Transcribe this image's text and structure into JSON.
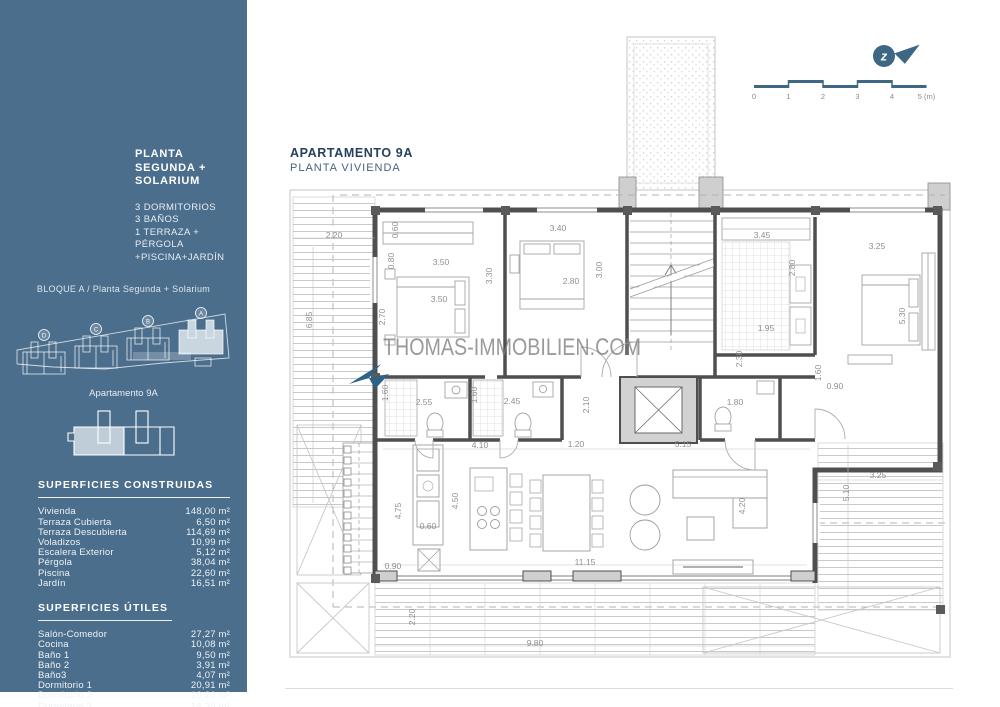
{
  "colors": {
    "sidebar_bg": "#4b6e8c",
    "accent_dark": "#24425e",
    "plan_wall": "#4f4f4f",
    "brand_blue": "#3e6784",
    "watermark_gray": "#7d7d7d",
    "highlight_block": "#c9d6e0"
  },
  "sidebar": {
    "title_line1": "PLANTA SEGUNDA +",
    "title_line2": "SOLARIUM",
    "features": [
      "3 DORMITORIOS",
      "3 BAÑOS",
      "1 TERRAZA + PÉRGOLA",
      "+PISCINA+JARDÍN"
    ],
    "block_caption": "BLOQUE A / Planta Segunda + Solarium",
    "block_labels": [
      "D",
      "C",
      "B",
      "A"
    ],
    "apartment_caption": "Apartamento 9A",
    "constructed": {
      "heading": "SUPERFICIES CONSTRUIDAS",
      "rows": [
        {
          "label": "Vivienda",
          "value": "148,00 m²"
        },
        {
          "label": "Terraza Cubierta",
          "value": "6,50 m²"
        },
        {
          "label": "Terraza Descubierta",
          "value": "114,69 m²"
        },
        {
          "label": "Voladizos",
          "value": "10,99 m²"
        },
        {
          "label": "Escalera Exterior",
          "value": "5,12 m²"
        },
        {
          "label": "Pérgola",
          "value": "38,04 m²"
        },
        {
          "label": "Piscina",
          "value": "22,60 m²"
        },
        {
          "label": "Jardín",
          "value": "16,51 m²"
        }
      ]
    },
    "useful": {
      "heading": "SUPERFICIES ÚTILES",
      "rows": [
        {
          "label": "Salón-Comedor",
          "value": "27,27 m²"
        },
        {
          "label": "Cocina",
          "value": "10,08 m²"
        },
        {
          "label": "Baño 1",
          "value": "9,50 m²"
        },
        {
          "label": "Baño 2",
          "value": "3,91 m²"
        },
        {
          "label": "Baño3",
          "value": "4,07 m²"
        },
        {
          "label": "Dormitorio 1",
          "value": "20,91 m²"
        },
        {
          "label": "Dormitorio 2",
          "value": "10,20 m²"
        },
        {
          "label": "Dormitorio 3",
          "value": "14,35 m²"
        },
        {
          "label": "Vestidor",
          "value": "5,00 m²"
        },
        {
          "label": "Inodoro",
          "value": "1,74 m²"
        },
        {
          "label": "Paso",
          "value": "5,75 m²"
        }
      ]
    }
  },
  "main": {
    "title": "APARTAMENTO 9A",
    "subtitle": "PLANTA VIVIENDA",
    "watermark": "THOMAS-IMMOBILIEN.COM",
    "compass_letter": "z",
    "scale": {
      "ticks": [
        "0",
        "1",
        "2",
        "3",
        "4",
        "5 (m)"
      ]
    }
  },
  "plan": {
    "dimensions": [
      {
        "t": "2.20",
        "x": 49,
        "y": 213,
        "r": 0
      },
      {
        "t": "6.85",
        "x": 27,
        "y": 295,
        "r": -90
      },
      {
        "t": "0.60",
        "x": 113,
        "y": 205,
        "r": -90
      },
      {
        "t": "0.80",
        "x": 109,
        "y": 236,
        "r": -90
      },
      {
        "t": "3.50",
        "x": 156,
        "y": 240,
        "r": 0
      },
      {
        "t": "3.50",
        "x": 154,
        "y": 277,
        "r": 0
      },
      {
        "t": "2.70",
        "x": 100,
        "y": 292,
        "r": -90
      },
      {
        "t": "3.30",
        "x": 207,
        "y": 251,
        "r": -90
      },
      {
        "t": "3.40",
        "x": 273,
        "y": 206,
        "r": 0
      },
      {
        "t": "2.80",
        "x": 286,
        "y": 259,
        "r": 0
      },
      {
        "t": "3.00",
        "x": 317,
        "y": 245,
        "r": -90
      },
      {
        "t": "3.45",
        "x": 477,
        "y": 213,
        "r": 0
      },
      {
        "t": "2.80",
        "x": 510,
        "y": 243,
        "r": -90
      },
      {
        "t": "3.25",
        "x": 592,
        "y": 224,
        "r": 0
      },
      {
        "t": "5.30",
        "x": 620,
        "y": 291,
        "r": -90
      },
      {
        "t": "1.95",
        "x": 481,
        "y": 306,
        "r": 0
      },
      {
        "t": "2.30",
        "x": 457,
        "y": 334,
        "r": -90
      },
      {
        "t": "1.60",
        "x": 536,
        "y": 348,
        "r": -90
      },
      {
        "t": "0.90",
        "x": 550,
        "y": 364,
        "r": 0
      },
      {
        "t": "1.80",
        "x": 450,
        "y": 380,
        "r": 0
      },
      {
        "t": "2.10",
        "x": 304,
        "y": 380,
        "r": -90
      },
      {
        "t": "1.60",
        "x": 103,
        "y": 368,
        "r": -90
      },
      {
        "t": "2.55",
        "x": 139,
        "y": 380,
        "r": 0
      },
      {
        "t": "1.60",
        "x": 192,
        "y": 370,
        "r": -90
      },
      {
        "t": "2.45",
        "x": 227,
        "y": 379,
        "r": 0
      },
      {
        "t": "4.10",
        "x": 195,
        "y": 423,
        "r": 0
      },
      {
        "t": "1.20",
        "x": 291,
        "y": 422,
        "r": 0
      },
      {
        "t": "5.15",
        "x": 398,
        "y": 422,
        "r": 0
      },
      {
        "t": "4.50",
        "x": 173,
        "y": 476,
        "r": -90
      },
      {
        "t": "4.75",
        "x": 116,
        "y": 486,
        "r": -90
      },
      {
        "t": "0.60",
        "x": 143,
        "y": 504,
        "r": 0
      },
      {
        "t": "0.90",
        "x": 108,
        "y": 544,
        "r": 0
      },
      {
        "t": "11.15",
        "x": 300,
        "y": 540,
        "r": 0
      },
      {
        "t": "4.20",
        "x": 460,
        "y": 481,
        "r": -90
      },
      {
        "t": "3.25",
        "x": 593,
        "y": 453,
        "r": 0
      },
      {
        "t": "5.10",
        "x": 564,
        "y": 468,
        "r": -90
      },
      {
        "t": "2.20",
        "x": 130,
        "y": 592,
        "r": -90
      },
      {
        "t": "9.80",
        "x": 250,
        "y": 621,
        "r": 0
      }
    ]
  }
}
